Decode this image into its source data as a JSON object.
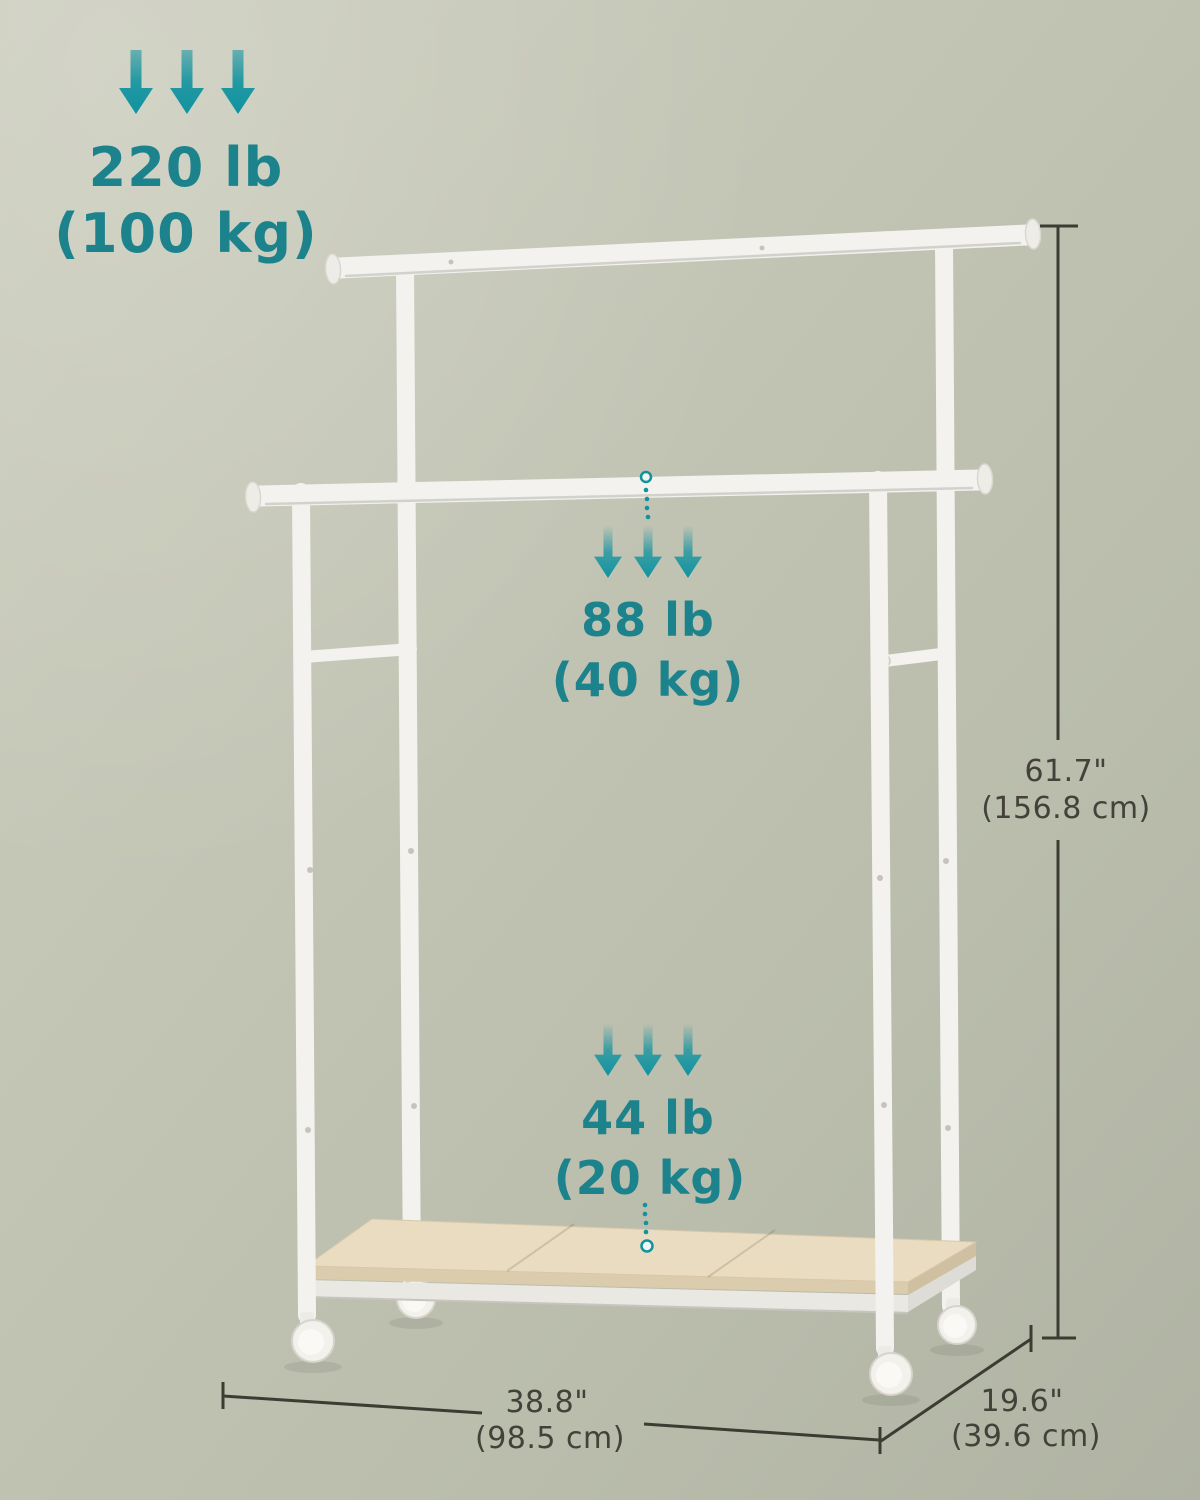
{
  "capacities": {
    "top_rod": {
      "imperial": "220 lb",
      "metric": "(100 kg)"
    },
    "lower_rod": {
      "imperial": "88 lb",
      "metric": "(40 kg)"
    },
    "shelf": {
      "imperial": "44 lb",
      "metric": "(20 kg)"
    }
  },
  "dimensions": {
    "height": {
      "imperial": "61.7\"",
      "metric": "(156.8 cm)"
    },
    "width": {
      "imperial": "38.8\"",
      "metric": "(98.5 cm)"
    },
    "depth": {
      "imperial": "19.6\"",
      "metric": "(39.6 cm)"
    }
  },
  "icons": {
    "load_arrows": "triple-down-arrow",
    "attach_point": "dotted-connector-circle"
  },
  "colors": {
    "background_light": "#c9cbbb",
    "background_dark": "#b2b5a5",
    "accent_teal_text": "#1c828c",
    "accent_teal_arrow": "#10929f",
    "dimension_line": "#3c3c33",
    "rack_white": "#f3f2ee",
    "shelf_wood": "#e9dcc1"
  }
}
